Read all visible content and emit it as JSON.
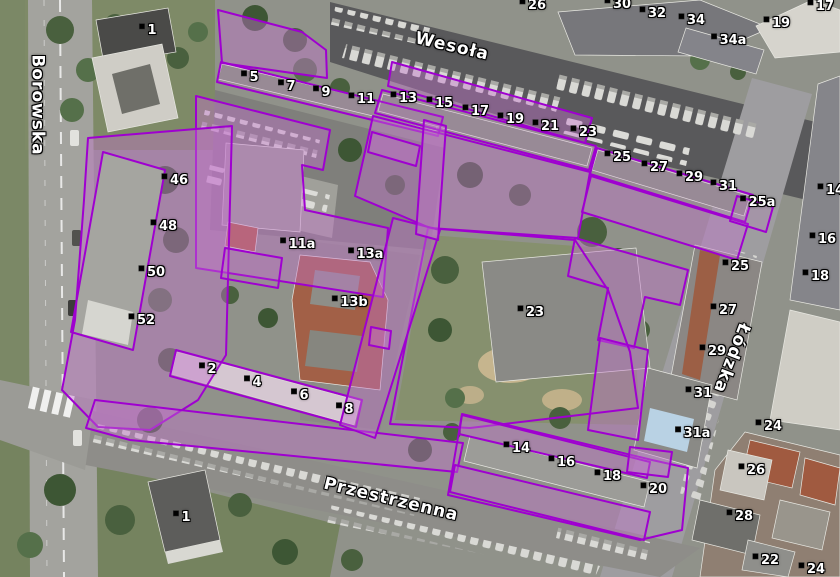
{
  "map": {
    "streets": [
      {
        "name": "Borowska",
        "x": 37,
        "y": 105,
        "rotate": 90
      },
      {
        "name": "Wesoła",
        "x": 452,
        "y": 47,
        "rotate": 13
      },
      {
        "name": "Łódzka",
        "x": 731,
        "y": 358,
        "rotate": 111
      },
      {
        "name": "Przestrzenna",
        "x": 391,
        "y": 500,
        "rotate": 13.5
      }
    ],
    "house_numbers": [
      {
        "text": "1",
        "x": 148,
        "y": 31
      },
      {
        "text": "5",
        "x": 250,
        "y": 78
      },
      {
        "text": "7",
        "x": 287,
        "y": 87
      },
      {
        "text": "9",
        "x": 322,
        "y": 93
      },
      {
        "text": "11",
        "x": 362,
        "y": 100
      },
      {
        "text": "13",
        "x": 404,
        "y": 99
      },
      {
        "text": "15",
        "x": 440,
        "y": 104
      },
      {
        "text": "17",
        "x": 476,
        "y": 112
      },
      {
        "text": "19",
        "x": 511,
        "y": 120
      },
      {
        "text": "21",
        "x": 546,
        "y": 127
      },
      {
        "text": "23",
        "x": 584,
        "y": 133
      },
      {
        "text": "25",
        "x": 618,
        "y": 158
      },
      {
        "text": "27",
        "x": 655,
        "y": 168
      },
      {
        "text": "29",
        "x": 690,
        "y": 178
      },
      {
        "text": "31",
        "x": 724,
        "y": 187
      },
      {
        "text": "25a",
        "x": 758,
        "y": 203
      },
      {
        "text": "46",
        "x": 175,
        "y": 181
      },
      {
        "text": "48",
        "x": 164,
        "y": 227
      },
      {
        "text": "50",
        "x": 152,
        "y": 273
      },
      {
        "text": "52",
        "x": 142,
        "y": 321
      },
      {
        "text": "11a",
        "x": 298,
        "y": 245
      },
      {
        "text": "13a",
        "x": 366,
        "y": 255
      },
      {
        "text": "13b",
        "x": 350,
        "y": 303
      },
      {
        "text": "23",
        "x": 531,
        "y": 313
      },
      {
        "text": "2",
        "x": 208,
        "y": 370
      },
      {
        "text": "4",
        "x": 253,
        "y": 383
      },
      {
        "text": "6",
        "x": 300,
        "y": 396
      },
      {
        "text": "8",
        "x": 345,
        "y": 410
      },
      {
        "text": "14",
        "x": 517,
        "y": 449
      },
      {
        "text": "16",
        "x": 562,
        "y": 463
      },
      {
        "text": "18",
        "x": 608,
        "y": 477
      },
      {
        "text": "20",
        "x": 654,
        "y": 490
      },
      {
        "text": "31",
        "x": 699,
        "y": 394
      },
      {
        "text": "31a",
        "x": 693,
        "y": 434
      },
      {
        "text": "25",
        "x": 736,
        "y": 267
      },
      {
        "text": "27",
        "x": 724,
        "y": 311
      },
      {
        "text": "29",
        "x": 713,
        "y": 352
      },
      {
        "text": "14",
        "x": 831,
        "y": 191
      },
      {
        "text": "16",
        "x": 823,
        "y": 240
      },
      {
        "text": "18",
        "x": 816,
        "y": 277
      },
      {
        "text": "24",
        "x": 769,
        "y": 427
      },
      {
        "text": "26",
        "x": 752,
        "y": 471
      },
      {
        "text": "28",
        "x": 740,
        "y": 517
      },
      {
        "text": "22",
        "x": 766,
        "y": 561
      },
      {
        "text": "24",
        "x": 812,
        "y": 570
      },
      {
        "text": "1",
        "x": 182,
        "y": 518
      },
      {
        "text": "26",
        "x": 533,
        "y": 6
      },
      {
        "text": "30",
        "x": 618,
        "y": 5
      },
      {
        "text": "32",
        "x": 653,
        "y": 14
      },
      {
        "text": "34",
        "x": 692,
        "y": 21
      },
      {
        "text": "34a",
        "x": 729,
        "y": 41
      },
      {
        "text": "19",
        "x": 777,
        "y": 24
      },
      {
        "text": "17",
        "x": 821,
        "y": 7
      }
    ],
    "colors": {
      "parcel_border": "#9f00d0",
      "parcel_fill": "#c473cc",
      "label_text": "#ffffff",
      "label_halo": "#000000"
    }
  }
}
